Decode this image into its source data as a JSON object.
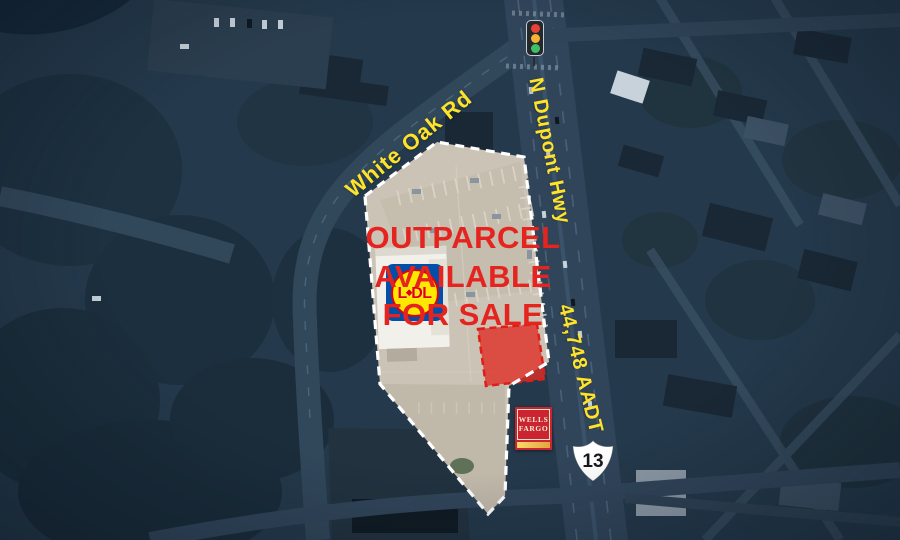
{
  "headline": {
    "line1": "OUTPARCEL",
    "line2": "AVAILABLE",
    "line3": "FOR SALE"
  },
  "road_labels": {
    "white_oak_rd": "White Oak Rd",
    "n_dupont_hwy": "N Dupont Hwy",
    "traffic_count": "44,748 AADT"
  },
  "route_shield": {
    "number": "13"
  },
  "tenant_signs": {
    "wells_fargo_line1": "WELLS",
    "wells_fargo_line2": "FARGO",
    "lidl_l": "L",
    "lidl_dot": "◆",
    "lidl_dl": "DL"
  },
  "icons": {
    "traffic_light": "traffic-light-icon",
    "route_shield": "us-route-shield-icon"
  },
  "colors": {
    "headline_red": "#e5241f",
    "label_yellow": "#ffe32a",
    "outparcel_red": "#df2f27",
    "parcel_highlight": "#cbc3b5",
    "basemap_navy": "#24394b",
    "wells_fargo_red": "#ca2430",
    "lidl_blue": "#0050aa",
    "lidl_yellow": "#ffe800",
    "dashed_boundary_white": "#ffffff"
  }
}
